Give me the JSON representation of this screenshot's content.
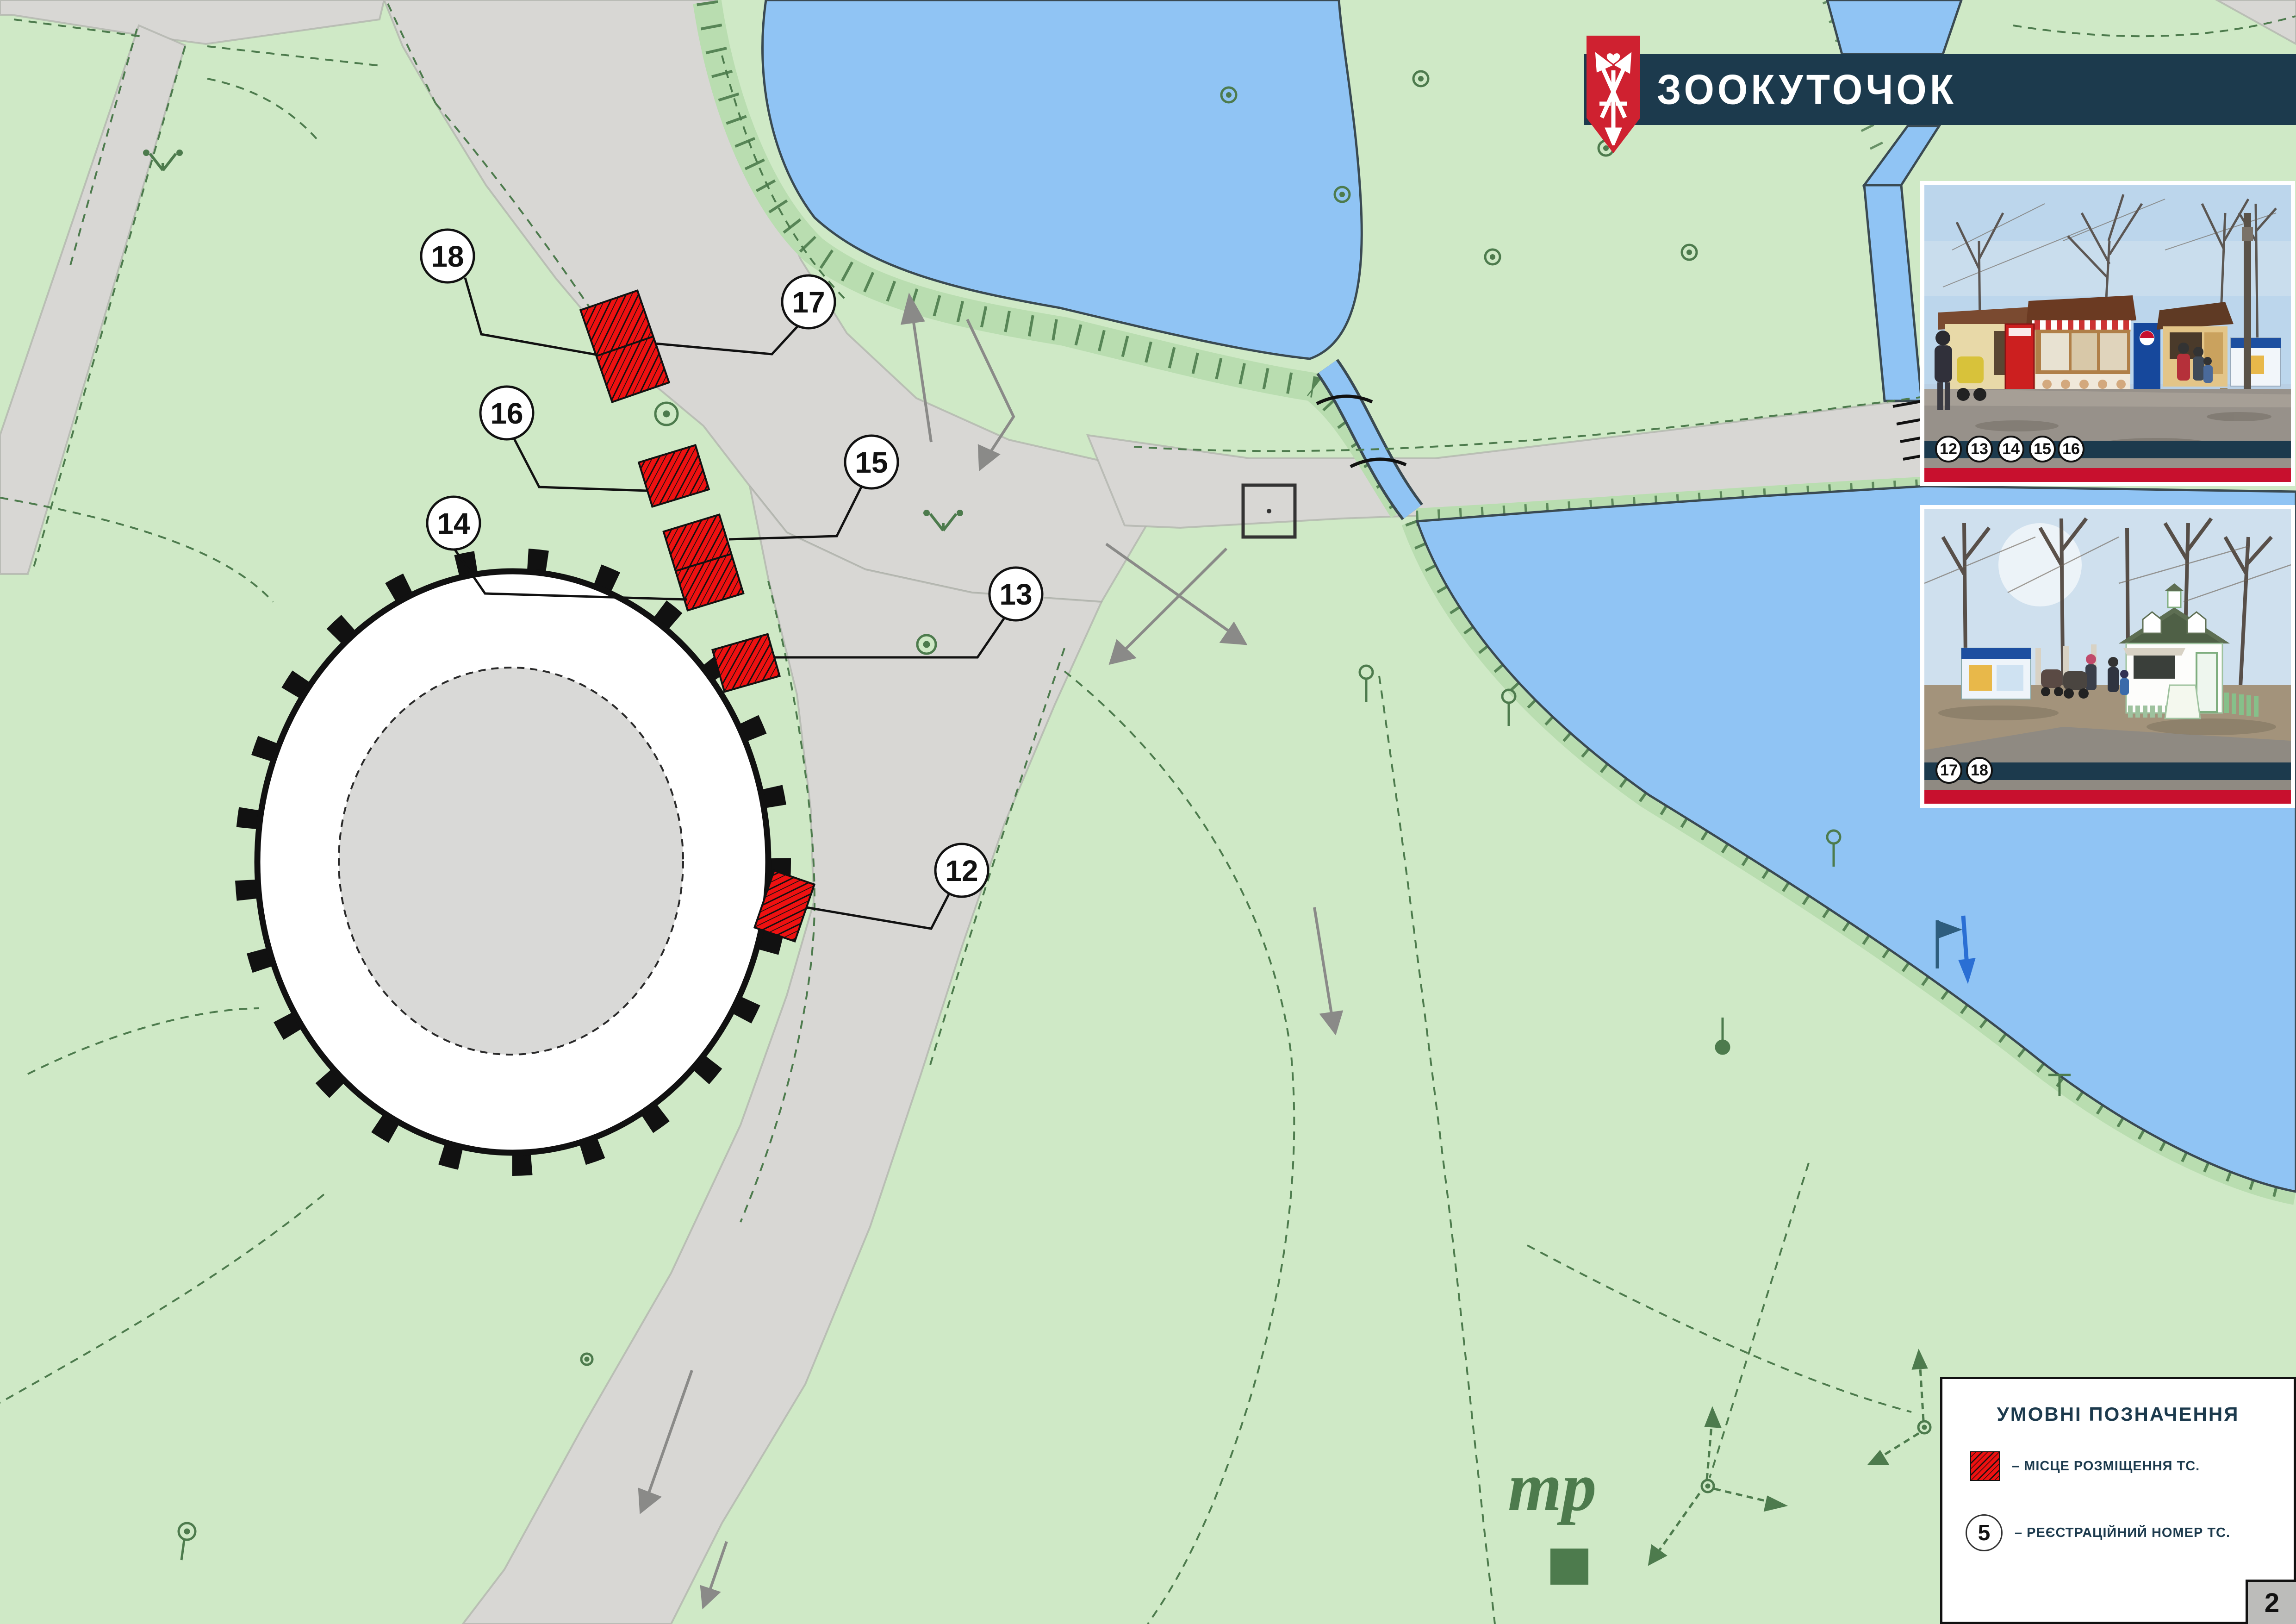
{
  "banner": {
    "title": "ЗООКУТОЧОК"
  },
  "map": {
    "markers": [
      {
        "label": "18"
      },
      {
        "label": "17"
      },
      {
        "label": "16"
      },
      {
        "label": "15"
      },
      {
        "label": "14"
      },
      {
        "label": "13"
      },
      {
        "label": "12"
      }
    ],
    "symbols": {
      "tr": "тр"
    }
  },
  "photos": [
    {
      "badges": [
        "12",
        "13",
        "14",
        "15",
        "16"
      ]
    },
    {
      "badges": [
        "17",
        "18"
      ]
    }
  ],
  "legend": {
    "title": "УМОВНІ ПОЗНАЧЕННЯ",
    "items": [
      {
        "label": "–  МІСЦЕ РОЗМІЩЕННЯ ТС."
      },
      {
        "label": "–  РЕЄСТРАЦІЙНИЙ НОМЕР ТС.",
        "circle_number": "5"
      }
    ]
  },
  "page_number": "2"
}
